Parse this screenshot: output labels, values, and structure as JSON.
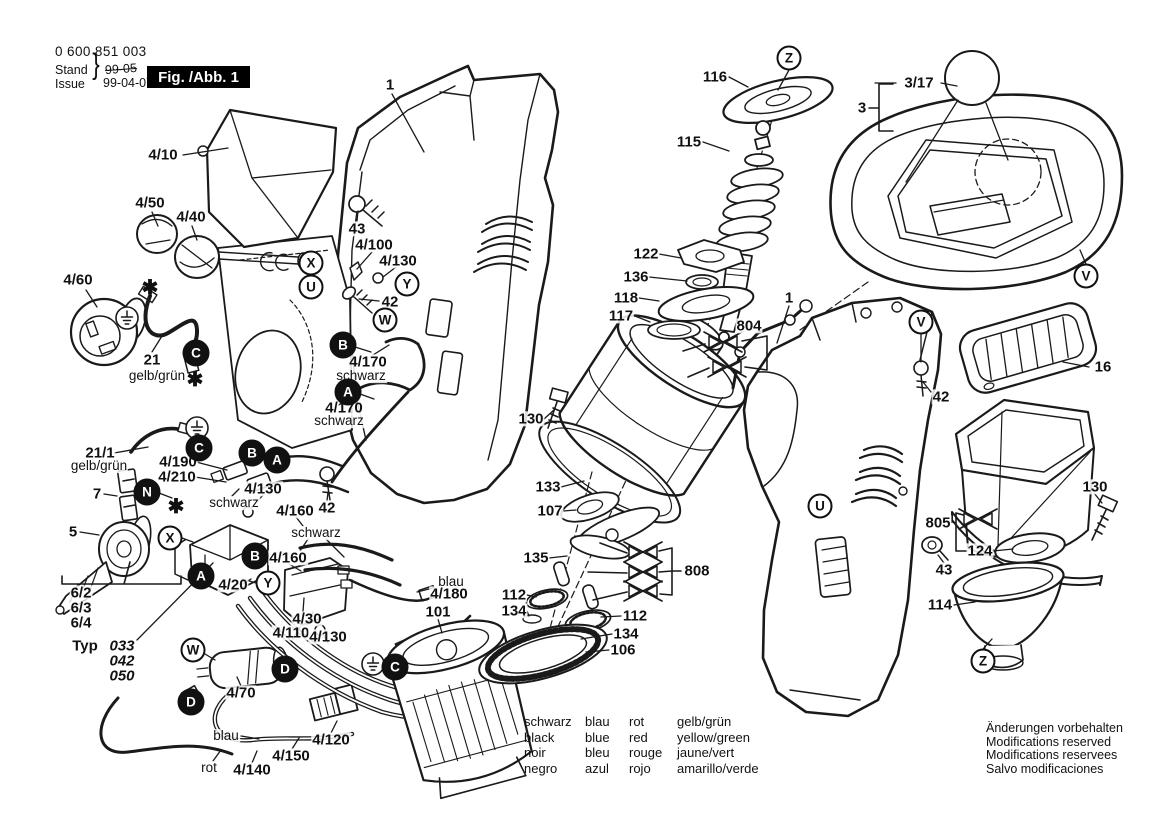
{
  "doc": {
    "part_number": "0 600 851 003",
    "stand_label": "Stand",
    "issue_label": "Issue",
    "brace": "}",
    "superseded_date": "99-05",
    "issue_date": "99-04-07",
    "figure_title": "Fig. /Abb. 1"
  },
  "legend": {
    "columns": [
      [
        "schwarz",
        "black",
        "noir",
        "negro"
      ],
      [
        "blau",
        "blue",
        "bleu",
        "azul"
      ],
      [
        "rot",
        "red",
        "rouge",
        "rojo"
      ],
      [
        "gelb/grün",
        "yellow/green",
        "jaune/vert",
        "amarillo/verde"
      ]
    ]
  },
  "notice": [
    "Änderungen vorbehalten",
    "Modifications reserved",
    "Modifications reservees",
    "Salvo modificaciones"
  ],
  "diagram": {
    "labels": [
      {
        "t": "1",
        "x": 390,
        "y": 85
      },
      {
        "t": "4/10",
        "x": 163,
        "y": 155
      },
      {
        "t": "4/50",
        "x": 150,
        "y": 203
      },
      {
        "t": "4/40",
        "x": 191,
        "y": 217
      },
      {
        "t": "4/60",
        "x": 78,
        "y": 280
      },
      {
        "t": "21",
        "x": 152,
        "y": 360
      },
      {
        "t": "gelb/grün",
        "x": 157,
        "y": 376,
        "s": "n"
      },
      {
        "t": "43",
        "x": 357,
        "y": 229
      },
      {
        "t": "4/100",
        "x": 374,
        "y": 245
      },
      {
        "t": "4/130",
        "x": 398,
        "y": 261
      },
      {
        "t": "42",
        "x": 390,
        "y": 302
      },
      {
        "t": "4/170",
        "x": 368,
        "y": 362
      },
      {
        "t": "schwarz",
        "x": 361,
        "y": 376,
        "s": "n"
      },
      {
        "t": "4/170",
        "x": 344,
        "y": 408
      },
      {
        "t": "schwarz",
        "x": 339,
        "y": 421,
        "s": "n"
      },
      {
        "t": "21/1",
        "x": 100,
        "y": 453
      },
      {
        "t": "gelb/grün",
        "x": 99,
        "y": 466,
        "s": "n"
      },
      {
        "t": "7",
        "x": 97,
        "y": 494
      },
      {
        "t": "4/190",
        "x": 178,
        "y": 462
      },
      {
        "t": "4/210",
        "x": 177,
        "y": 477
      },
      {
        "t": "4/130",
        "x": 263,
        "y": 489
      },
      {
        "t": "schwarz",
        "x": 234,
        "y": 503,
        "s": "n"
      },
      {
        "t": "5",
        "x": 73,
        "y": 532
      },
      {
        "t": "4/160",
        "x": 295,
        "y": 511
      },
      {
        "t": "schwarz",
        "x": 316,
        "y": 533,
        "s": "n"
      },
      {
        "t": "4/160",
        "x": 288,
        "y": 558
      },
      {
        "t": "42",
        "x": 327,
        "y": 508
      },
      {
        "t": "4/20",
        "x": 233,
        "y": 585
      },
      {
        "t": "6/2",
        "x": 81,
        "y": 593
      },
      {
        "t": "6/3",
        "x": 81,
        "y": 608
      },
      {
        "t": "6/4",
        "x": 81,
        "y": 623
      },
      {
        "t": "Typ",
        "x": 85,
        "y": 646
      },
      {
        "t": "033",
        "x": 122,
        "y": 646,
        "s": "bi"
      },
      {
        "t": "042",
        "x": 122,
        "y": 661,
        "s": "bi"
      },
      {
        "t": "050",
        "x": 122,
        "y": 676,
        "s": "bi"
      },
      {
        "t": "4/30",
        "x": 307,
        "y": 619
      },
      {
        "t": "4/110",
        "x": 291,
        "y": 633
      },
      {
        "t": "4/130",
        "x": 328,
        "y": 637
      },
      {
        "t": "blau",
        "x": 451,
        "y": 582,
        "s": "n"
      },
      {
        "t": "4/180",
        "x": 449,
        "y": 594
      },
      {
        "t": "101",
        "x": 438,
        "y": 612
      },
      {
        "t": "4/70",
        "x": 241,
        "y": 693
      },
      {
        "t": "blau",
        "x": 226,
        "y": 736,
        "s": "n"
      },
      {
        "t": "4/120",
        "x": 331,
        "y": 740
      },
      {
        "t": "4/150",
        "x": 291,
        "y": 756
      },
      {
        "t": "rot",
        "x": 209,
        "y": 768,
        "s": "n"
      },
      {
        "t": "4/140",
        "x": 252,
        "y": 770
      },
      {
        "t": "116",
        "x": 715,
        "y": 77
      },
      {
        "t": "115",
        "x": 689,
        "y": 142
      },
      {
        "t": "122",
        "x": 646,
        "y": 254
      },
      {
        "t": "136",
        "x": 636,
        "y": 277
      },
      {
        "t": "118",
        "x": 626,
        "y": 298
      },
      {
        "t": "117",
        "x": 621,
        "y": 316
      },
      {
        "t": "804",
        "x": 749,
        "y": 326
      },
      {
        "t": "1",
        "x": 789,
        "y": 298
      },
      {
        "t": "130",
        "x": 531,
        "y": 419
      },
      {
        "t": "133",
        "x": 548,
        "y": 487
      },
      {
        "t": "107",
        "x": 550,
        "y": 511
      },
      {
        "t": "135",
        "x": 536,
        "y": 558
      },
      {
        "t": "808",
        "x": 697,
        "y": 571
      },
      {
        "t": "112",
        "x": 514,
        "y": 595
      },
      {
        "t": "134",
        "x": 514,
        "y": 611
      },
      {
        "t": "112",
        "x": 635,
        "y": 616
      },
      {
        "t": "134",
        "x": 626,
        "y": 634
      },
      {
        "t": "106",
        "x": 623,
        "y": 650
      },
      {
        "t": "3/17",
        "x": 919,
        "y": 83
      },
      {
        "t": "3",
        "x": 862,
        "y": 108
      },
      {
        "t": "16",
        "x": 1103,
        "y": 367
      },
      {
        "t": "42",
        "x": 941,
        "y": 397
      },
      {
        "t": "130",
        "x": 1095,
        "y": 487
      },
      {
        "t": "805",
        "x": 938,
        "y": 523
      },
      {
        "t": "124",
        "x": 980,
        "y": 551
      },
      {
        "t": "43",
        "x": 944,
        "y": 570
      },
      {
        "t": "114",
        "x": 940,
        "y": 605
      }
    ],
    "callouts": [
      {
        "l": "Z",
        "x": 789,
        "y": 58
      },
      {
        "l": "X",
        "x": 311,
        "y": 263
      },
      {
        "l": "U",
        "x": 311,
        "y": 287
      },
      {
        "l": "Y",
        "x": 407,
        "y": 284
      },
      {
        "l": "W",
        "x": 385,
        "y": 320
      },
      {
        "l": "C",
        "x": 196,
        "y": 353,
        "f": 1
      },
      {
        "l": "B",
        "x": 343,
        "y": 345,
        "f": 1
      },
      {
        "l": "A",
        "x": 348,
        "y": 392,
        "f": 1
      },
      {
        "l": "C",
        "x": 199,
        "y": 448,
        "f": 1
      },
      {
        "l": "B",
        "x": 252,
        "y": 453,
        "f": 1
      },
      {
        "l": "A",
        "x": 277,
        "y": 460,
        "f": 1
      },
      {
        "l": "N",
        "x": 147,
        "y": 492,
        "f": 1
      },
      {
        "l": "X",
        "x": 170,
        "y": 538
      },
      {
        "l": "B",
        "x": 255,
        "y": 556,
        "f": 1
      },
      {
        "l": "A",
        "x": 201,
        "y": 576,
        "f": 1
      },
      {
        "l": "Y",
        "x": 268,
        "y": 583
      },
      {
        "l": "W",
        "x": 193,
        "y": 650
      },
      {
        "l": "D",
        "x": 285,
        "y": 669,
        "f": 1
      },
      {
        "l": "D",
        "x": 191,
        "y": 702,
        "f": 1
      },
      {
        "l": "C",
        "x": 395,
        "y": 667,
        "f": 1
      },
      {
        "l": "V",
        "x": 1086,
        "y": 276
      },
      {
        "l": "V",
        "x": 921,
        "y": 322
      },
      {
        "l": "U",
        "x": 820,
        "y": 506
      },
      {
        "l": "Z",
        "x": 983,
        "y": 661
      }
    ],
    "symbols": {
      "asterisks": [
        {
          "x": 150,
          "y": 288
        },
        {
          "x": 195,
          "y": 380
        },
        {
          "x": 176,
          "y": 507
        }
      ],
      "asterisk_char": "✱",
      "earth_ground": [
        {
          "x": 127,
          "y": 318
        },
        {
          "x": 197,
          "y": 428
        },
        {
          "x": 373,
          "y": 664
        }
      ],
      "discontinued_marks": [
        {
          "x": 723,
          "y": 342
        },
        {
          "x": 727,
          "y": 367
        },
        {
          "x": 643,
          "y": 552
        },
        {
          "x": 643,
          "y": 572
        },
        {
          "x": 643,
          "y": 591
        },
        {
          "x": 978,
          "y": 519
        }
      ]
    }
  }
}
